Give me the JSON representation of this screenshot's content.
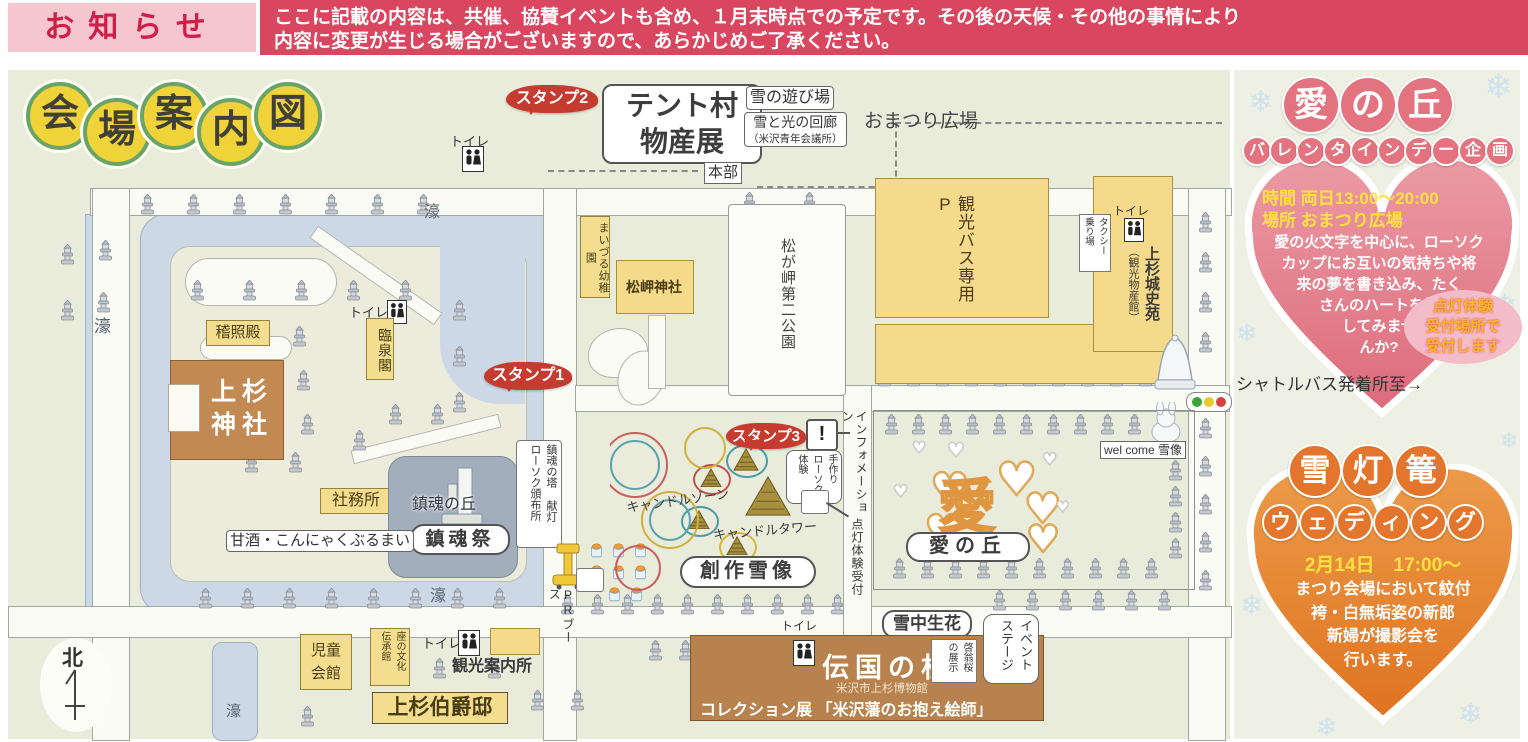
{
  "notice": {
    "label": "お知らせ",
    "line1": "ここに記載の内容は、共催、協賛イベントも含め、１月末時点での予定です。その後の天候・その他の事情により",
    "line2": "内容に変更が生じる場合がございますので、あらかじめご了承ください。"
  },
  "title": {
    "chars": [
      "会",
      "場",
      "案",
      "内",
      "図"
    ]
  },
  "map": {
    "moat_label": "濠",
    "keishoden": "稽照殿",
    "shrine_line1": "上杉",
    "shrine_line2": "神社",
    "toilet": "トイレ",
    "rinsenkaku": "臨泉閣",
    "shamusho": "社務所",
    "chinkon_hill": "鎮魂の丘",
    "chinkon_fes": "鎮魂祭",
    "amazake": "甘酒・こんにゃくぶるまい",
    "chinkon_tower_col1": "鎮魂の塔 献灯",
    "chinkon_tower_col2": "ローソク頒布所",
    "stamp1": "スタンプ1",
    "stamp2": "スタンプ2",
    "stamp3": "スタンプ3",
    "maizuru": "まいづる幼稚園",
    "matsugasaki_jinja": "松岬神社",
    "park": "松が岬第二公園",
    "bus_parking": "観光バス専用P",
    "taxi_col1": "タクシー",
    "taxi_col2": "乗り場",
    "joshien_col1": "上杉城史苑",
    "joshien_col2": "（観光物産館）",
    "tent_line1": "テント村",
    "tent_line2": "物産展",
    "yuki_asobiba": "雪の遊び場",
    "kairo_line1": "雪と光の回廊",
    "kairo_line2": "（米沢青年会議所）",
    "omatsuri": "おまつり広場",
    "honbu": "本部",
    "candle_zone": "キャンドルゾーン",
    "candle_tower": "キャンドルタワー",
    "tezukuri_col1": "手作り",
    "tezukuri_col2": "ローソク",
    "tezukuri_col3": "体験",
    "info_mark": "!",
    "information": "インフォメーション",
    "tento_uketsuke": "点灯体験受付",
    "sosaku": "創作雪像",
    "ai_no_oka": "愛の丘",
    "ai_char": "愛",
    "welcome": "wel come 雪像",
    "secchu": "雪中生花",
    "denkoku": "伝国の杜",
    "denkoku_sub": "米沢市上杉博物館",
    "collection": "コレクション展 「米沢藩のお抱え絵師」",
    "keio_col1": "啓翁桜",
    "keio_col2": "の展示",
    "stage_col1": "イベント",
    "stage_col2": "ステージ",
    "jido": "児童\n会館",
    "za_col1": "座の文化",
    "za_col2": "伝承館",
    "kanko_annai": "観光案内所",
    "hakushaku": "上杉伯爵邸",
    "north": "北",
    "pr_booth": "PRブース"
  },
  "right_panel": {
    "ai_title_chars": [
      "愛",
      "の",
      "丘"
    ],
    "ai_subtitle_chars": [
      "バ",
      "レ",
      "ン",
      "タ",
      "イ",
      "ン",
      "デ",
      "ー",
      "企",
      "画"
    ],
    "time_label": "時間 両日13:00～20:00",
    "place_label": "場所 おまつり広場",
    "ai_body": "愛の火文字を中心に、ローソク\nカップにお互いの気持ちや将\n来の夢を書き込み、たく\nさんのハートを灯\nしてみませ\nんか?",
    "badge": "点灯体験\n受付場所で\n受付します",
    "shuttle": "シャトルバス発着所至→",
    "wed_title_chars": [
      "雪",
      "灯",
      "篭"
    ],
    "wed_subtitle_chars": [
      "ウ",
      "ェ",
      "デ",
      "ィ",
      "ン",
      "グ"
    ],
    "wed_date": "2月14日　17:00～",
    "wed_body": "まつり会場において紋付\n袴・白無垢姿の新郎\n新婦が撮影会を\n行います。"
  },
  "colors": {
    "banner_red": "#d9465f",
    "banner_pink": "#f5c6ce",
    "notice_text": "#cf1e47",
    "stamp_red": "#c53b30",
    "heart_pink": "#e4808c",
    "heart_orange": "#e5822f",
    "map_bg": "#e9ecda",
    "moat_blue": "#ccd8e6",
    "building_yellow": "#f4da8a",
    "building_brown": "#c28a52",
    "hill_gray": "#a2aebc"
  },
  "decor": {
    "lantern_rows": [
      [
        140,
        194,
        7,
        46,
        0
      ],
      [
        742,
        192,
        2,
        60,
        0
      ],
      [
        98,
        240,
        1,
        0,
        0
      ],
      [
        96,
        292,
        1,
        0,
        0
      ],
      [
        60,
        244,
        1,
        0,
        0
      ],
      [
        60,
        300,
        1,
        0,
        0
      ],
      [
        190,
        280,
        5,
        52,
        0
      ],
      [
        292,
        326,
        1,
        0,
        0
      ],
      [
        296,
        370,
        1,
        0,
        0
      ],
      [
        300,
        414,
        1,
        0,
        0
      ],
      [
        452,
        300,
        3,
        0,
        46
      ],
      [
        388,
        404,
        2,
        42,
        0
      ],
      [
        352,
        430,
        1,
        0,
        0
      ],
      [
        244,
        452,
        2,
        44,
        0
      ],
      [
        198,
        588,
        8,
        42,
        0
      ],
      [
        560,
        594,
        10,
        30,
        0
      ],
      [
        648,
        640,
        7,
        30,
        0
      ],
      [
        877,
        366,
        10,
        29,
        0
      ],
      [
        884,
        414,
        11,
        27,
        0
      ],
      [
        892,
        558,
        10,
        28,
        0
      ],
      [
        1168,
        460,
        4,
        0,
        26
      ],
      [
        1198,
        212,
        4,
        0,
        40
      ],
      [
        1198,
        418,
        5,
        0,
        38
      ],
      [
        992,
        590,
        6,
        33,
        0
      ],
      [
        432,
        658,
        2,
        55,
        0
      ],
      [
        300,
        706,
        1,
        0,
        0
      ],
      [
        530,
        690,
        2,
        40,
        0
      ]
    ],
    "candle_rows": [
      [
        747,
        244,
        6,
        0,
        23
      ],
      [
        808,
        244,
        6,
        0,
        23
      ],
      [
        590,
        543,
        3,
        22,
        0
      ],
      [
        590,
        565,
        3,
        22,
        0
      ],
      [
        608,
        587,
        2,
        22,
        0
      ]
    ],
    "snowflakes": [
      [
        1248,
        88,
        30
      ],
      [
        1484,
        70,
        34
      ],
      [
        1236,
        320,
        26
      ],
      [
        1492,
        292,
        30
      ],
      [
        1240,
        592,
        28
      ],
      [
        1488,
        556,
        34
      ],
      [
        1316,
        714,
        26
      ],
      [
        1458,
        700,
        30
      ],
      [
        1500,
        430,
        22
      ]
    ],
    "hearts": [
      [
        930,
        468,
        44,
        "o"
      ],
      [
        924,
        510,
        44,
        "o"
      ],
      [
        996,
        456,
        46,
        "o"
      ],
      [
        1024,
        488,
        42,
        "o"
      ],
      [
        1026,
        520,
        38,
        "o"
      ],
      [
        947,
        440,
        20,
        "w"
      ],
      [
        1042,
        452,
        17,
        "w"
      ],
      [
        1056,
        500,
        15,
        "w"
      ],
      [
        893,
        484,
        17,
        "w"
      ],
      [
        1005,
        546,
        15,
        "w"
      ],
      [
        912,
        440,
        16,
        "w"
      ]
    ],
    "pyramids": [
      [
        733,
        448,
        26,
        "#4a9aa8"
      ],
      [
        700,
        468,
        22,
        "#c05050"
      ],
      [
        745,
        476,
        46,
        ""
      ],
      [
        688,
        510,
        22,
        "#4a9aa8"
      ],
      [
        726,
        536,
        22,
        "#d8b830"
      ]
    ]
  }
}
